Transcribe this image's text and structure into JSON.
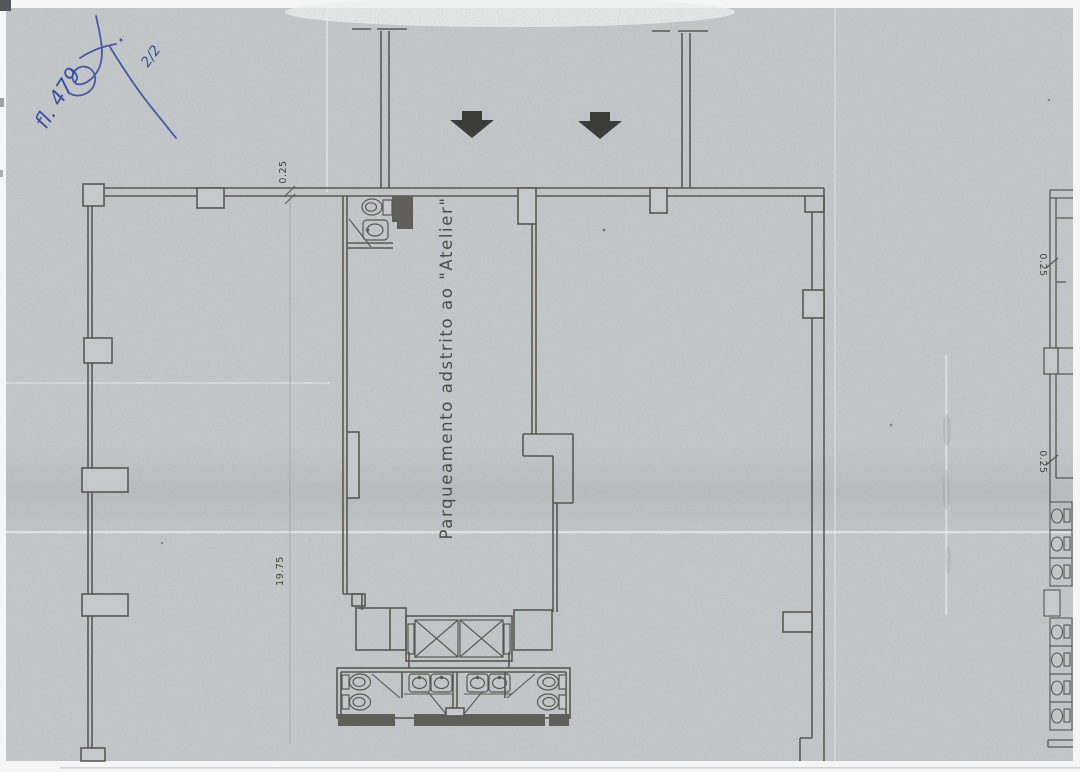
{
  "scan": {
    "handwriting": {
      "sheet_number": "fl. 479",
      "page_label": "2/2"
    },
    "plan": {
      "area_label": "Parqueamento  adstrito  ao  \"Atelier\"",
      "dim_wall_top": "0.25",
      "dim_depth_left": "19.75",
      "dim_wall_right_upper": "0.25",
      "dim_wall_right_lower": "0.25"
    },
    "icons": {
      "entrance": "down-arrow-icon",
      "elevator": "elevator-shaft-x-icon",
      "toilet": "toilet-icon",
      "washbasin": "washbasin-icon"
    },
    "colors": {
      "paper": "#c7cacc",
      "line": "#514f49",
      "wall_fill": "#57564f",
      "handwriting_ink": "#3b4f9f",
      "arrow_fill": "#3d3d38"
    }
  }
}
